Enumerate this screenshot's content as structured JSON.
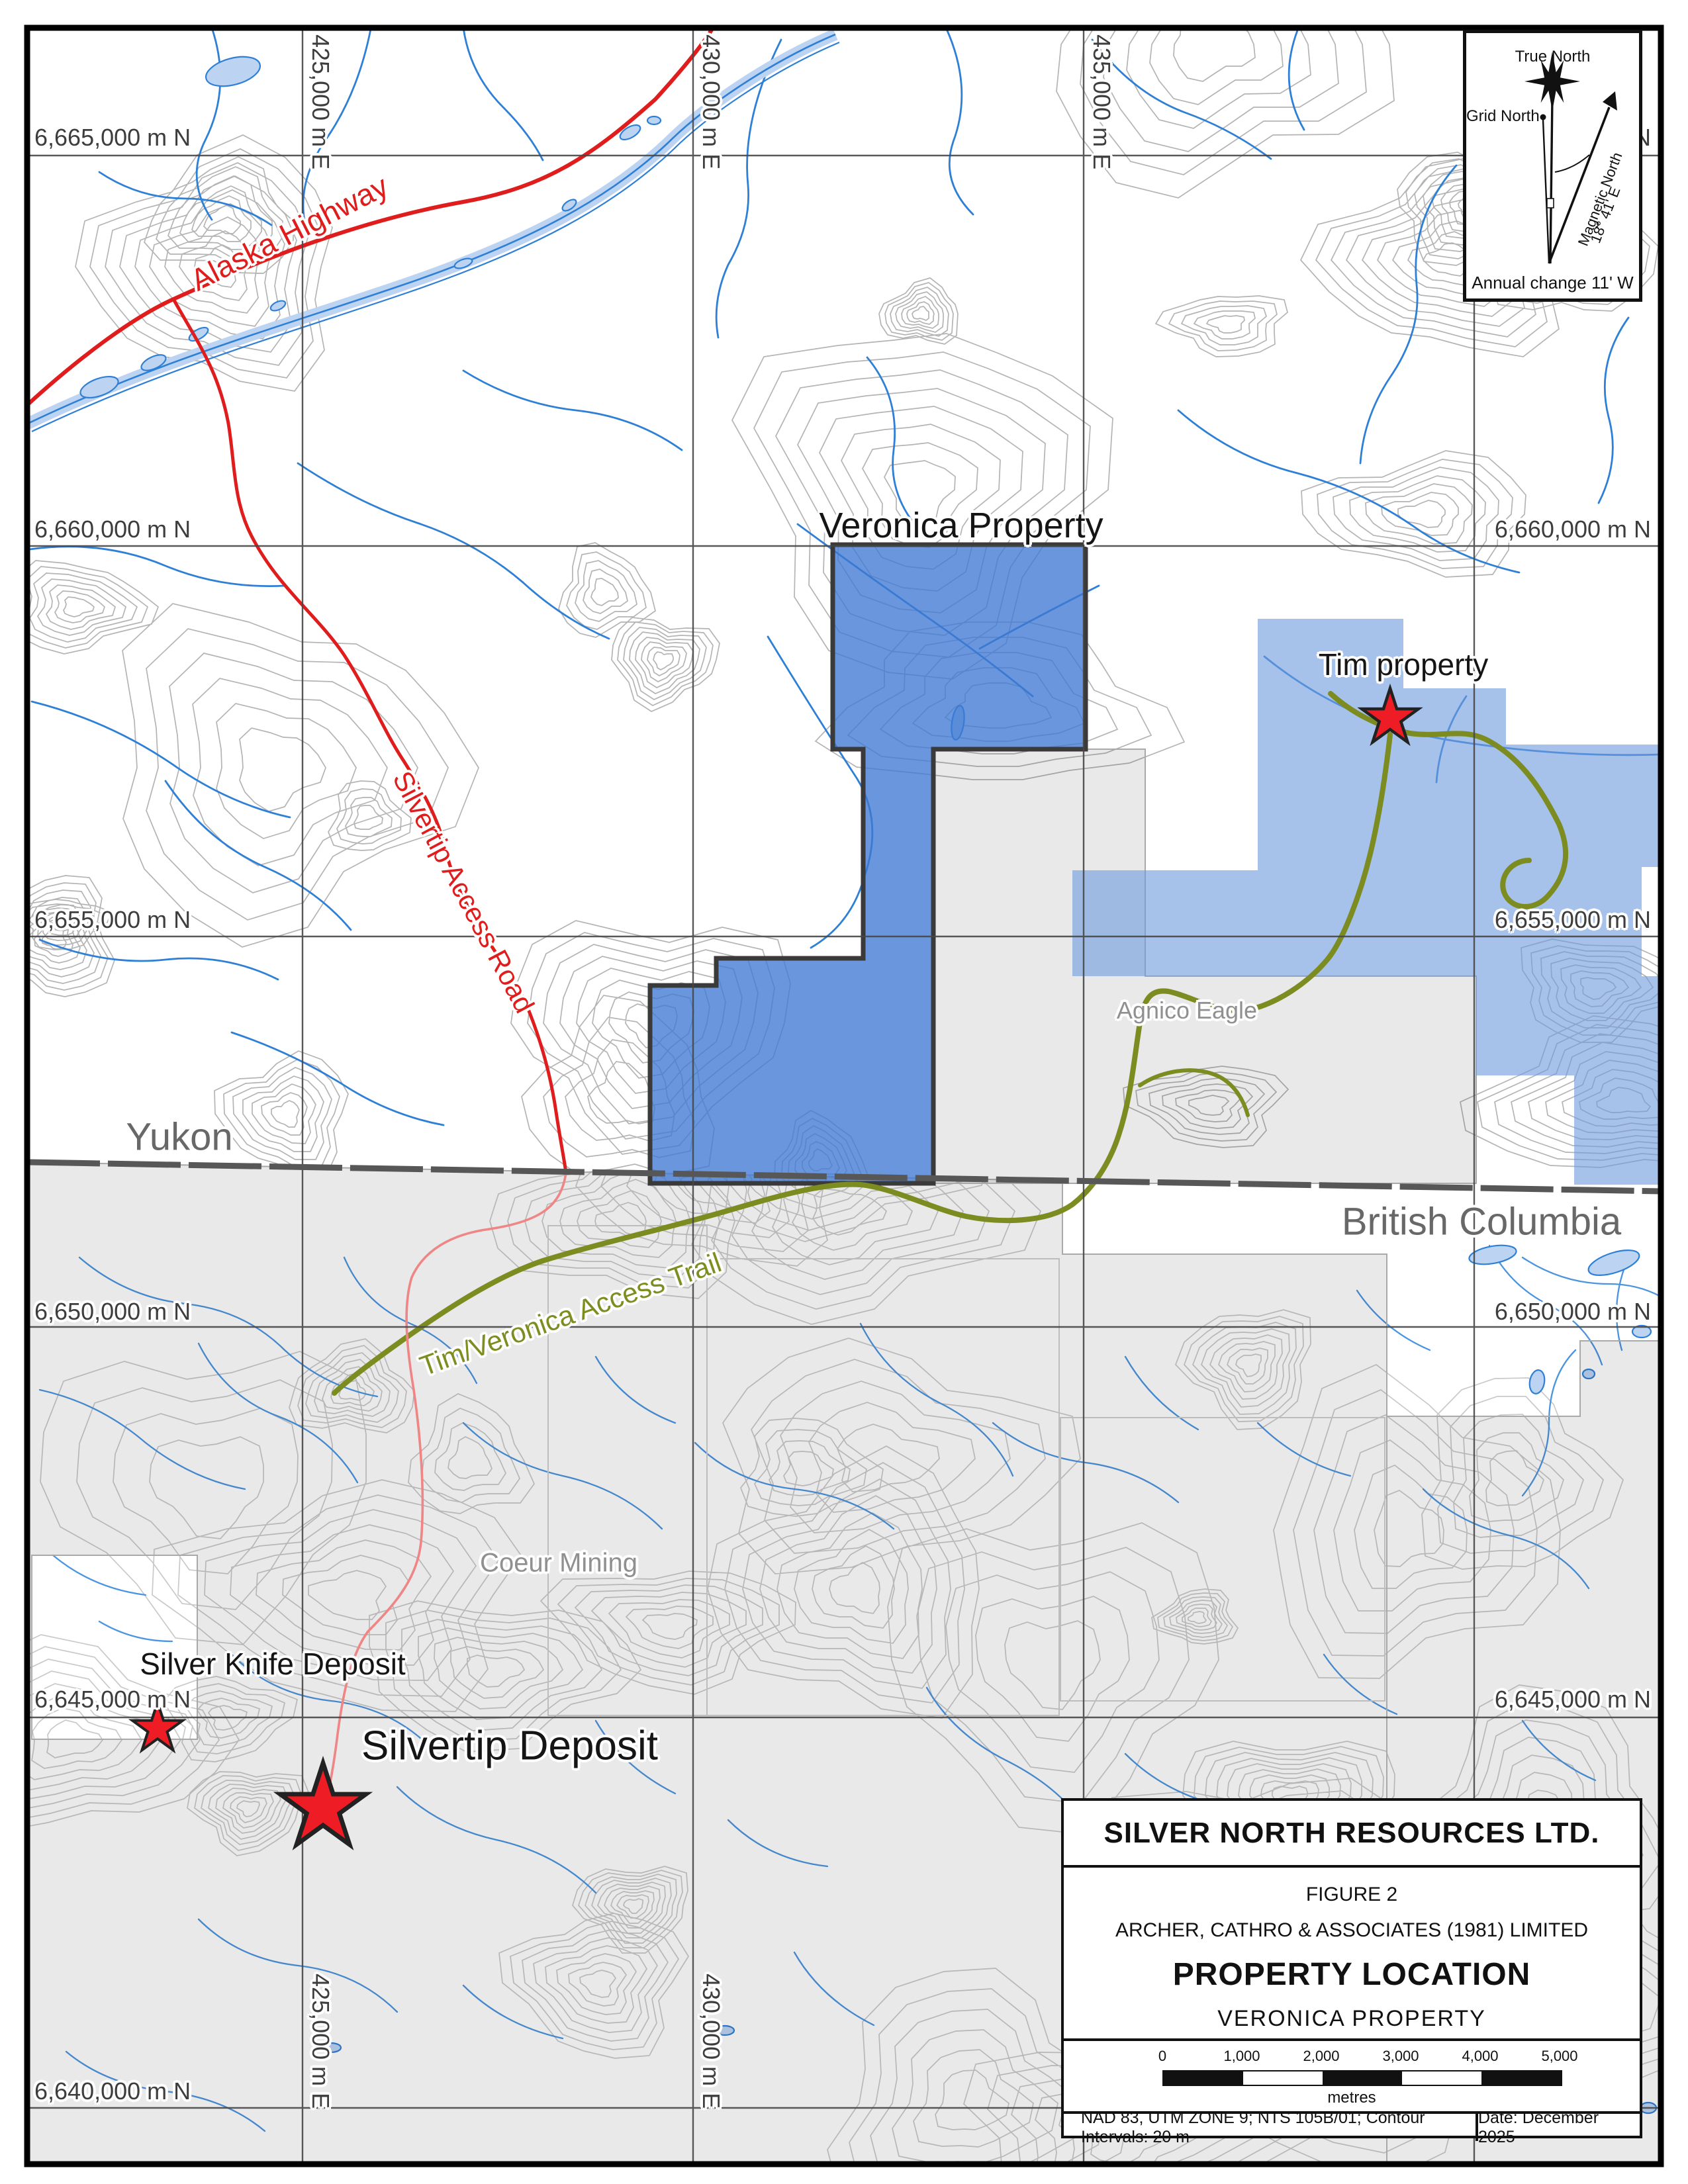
{
  "figure": {
    "map_labels": {
      "veronica_property": "Veronica Property",
      "tim_property": "Tim property",
      "yukon": "Yukon",
      "british_columbia": "British Columbia",
      "agnico_eagle": "Agnico Eagle",
      "coeur_mining": "Coeur Mining",
      "silver_knife_deposit": "Silver Knife Deposit",
      "silvertip_deposit": "Silvertip Deposit",
      "alaska_highway": "Alaska Highway",
      "silvertip_access_road": "Silvertip Access Road",
      "tim_veronica_access_trail": "Tim/Veronica Access Trail"
    },
    "grid": {
      "northings": [
        "6,665,000 m N",
        "6,660,000 m N",
        "6,655,000 m N",
        "6,650,000 m N",
        "6,645,000 m N",
        "6,640,000 m N"
      ],
      "eastings_top": [
        "425,000 m E",
        "430,000 m E",
        "435,000 m E"
      ],
      "eastings_bottom": [
        "425,000 m E",
        "430,000 m E"
      ]
    },
    "north_arrow": {
      "true_north": "True North",
      "grid_north": "Grid North",
      "magnetic_north": "Magnetic North",
      "magnetic_declination": "18° 41' E",
      "annual_change": "Annual change 11' W"
    },
    "title_block": {
      "company": "SILVER NORTH RESOURCES LTD.",
      "figure_no": "FIGURE 2",
      "consultant": "ARCHER, CATHRO & ASSOCIATES (1981) LIMITED",
      "title": "PROPERTY LOCATION",
      "subtitle": "VERONICA PROPERTY",
      "scale_ticks": [
        "0",
        "1,000",
        "2,000",
        "3,000",
        "4,000",
        "5,000"
      ],
      "scale_units": "metres",
      "datum_note": "NAD 83, UTM ZONE 9; NTS 105B/01; Contour Intervals: 20 m",
      "date_note": "Date: December 2025"
    },
    "colors": {
      "veronica_fill": "#4d82d6",
      "tim_fill": "#86a9e2",
      "claims_gray": "#e8e8e8",
      "road_red": "#e01d1d",
      "trail_olive": "#7d8d20",
      "water_blue": "#2e7fd6",
      "star_red": "#ee1c24"
    }
  }
}
